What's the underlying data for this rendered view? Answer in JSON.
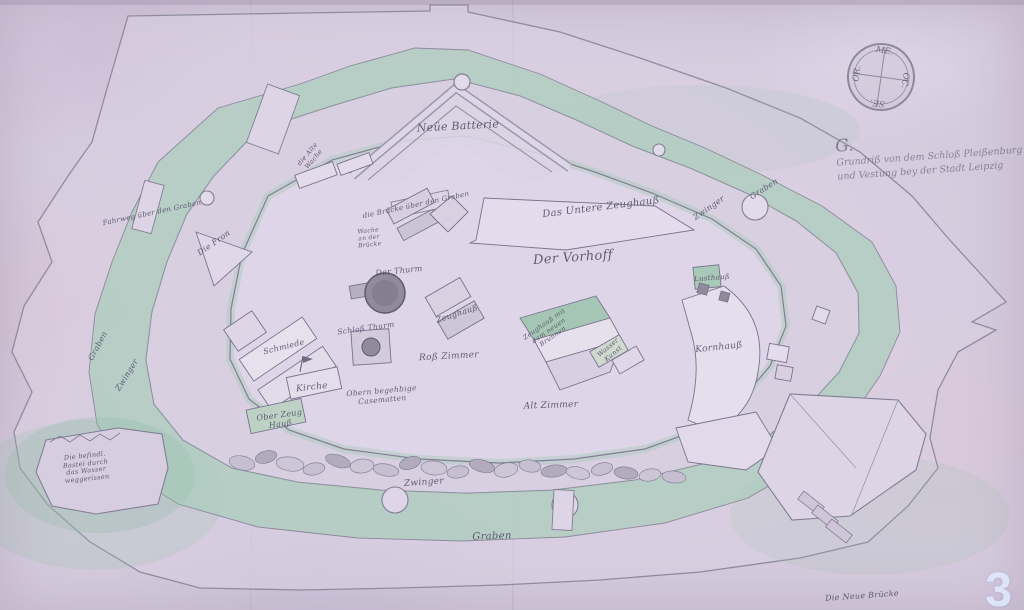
{
  "document": {
    "kind": "historic hand-drawn fortress plan (scanned manuscript map)",
    "watermark_number": "3"
  },
  "colors": {
    "paper": "#d6cbde",
    "moat_green": "#aecdbf",
    "ink": "#4e4660",
    "wall_line": "#827e93",
    "tower_shade": "#8f8a9c"
  },
  "title_block": {
    "flourish": "G.",
    "line1": "Grundriß von dem Schloß Pleißenburg",
    "line2": "und Vestung bey der Stadt Leipzig"
  },
  "compass": {
    "top": "ME.",
    "right": "OC.",
    "bottom": "SE.",
    "left": "OR."
  },
  "watermark": "3",
  "map_labels": [
    {
      "text": "Neüe Batterie",
      "x": 458,
      "y": 127,
      "rot": -3,
      "size": 11
    },
    {
      "text": "die Alte\nWache",
      "x": 311,
      "y": 157,
      "rot": -50,
      "size": 6.5
    },
    {
      "text": "Fahrweg über den Graben",
      "x": 152,
      "y": 213,
      "rot": -12,
      "size": 7
    },
    {
      "text": "Die Fron",
      "x": 214,
      "y": 243,
      "rot": -35,
      "size": 8
    },
    {
      "text": "die Brücke über den Graben",
      "x": 416,
      "y": 205,
      "rot": -12,
      "size": 7
    },
    {
      "text": "Wache\nan der\nBrücke",
      "x": 369,
      "y": 238,
      "rot": -6,
      "size": 6
    },
    {
      "text": "Das Untere Zeughauß",
      "x": 601,
      "y": 208,
      "rot": -7,
      "size": 10
    },
    {
      "text": "Der Vorhoff",
      "x": 573,
      "y": 258,
      "rot": -4,
      "size": 13
    },
    {
      "text": "Der Thurm",
      "x": 399,
      "y": 271,
      "rot": -6,
      "size": 8
    },
    {
      "text": "Zeughauß",
      "x": 457,
      "y": 314,
      "rot": -18,
      "size": 8
    },
    {
      "text": "Schloß Thurm",
      "x": 366,
      "y": 329,
      "rot": -8,
      "size": 7.5
    },
    {
      "text": "Schmiede",
      "x": 284,
      "y": 347,
      "rot": -14,
      "size": 8
    },
    {
      "text": "Kirche",
      "x": 312,
      "y": 388,
      "rot": -6,
      "size": 9
    },
    {
      "text": "Roß Zimmer",
      "x": 449,
      "y": 357,
      "rot": -3,
      "size": 9
    },
    {
      "text": "Obern begehbige\nCasematten",
      "x": 382,
      "y": 396,
      "rot": -5,
      "size": 7.5
    },
    {
      "text": "Ober Zeug\nHauß",
      "x": 280,
      "y": 420,
      "rot": -8,
      "size": 8
    },
    {
      "text": "Zeughauß mit\ndem neuen\nBrunnen",
      "x": 549,
      "y": 331,
      "rot": -35,
      "size": 6.5
    },
    {
      "text": "Wasser\nKunst",
      "x": 611,
      "y": 351,
      "rot": -40,
      "size": 6.5
    },
    {
      "text": "Alt Zimmer",
      "x": 551,
      "y": 406,
      "rot": -2,
      "size": 9
    },
    {
      "text": "Kornhauß",
      "x": 719,
      "y": 348,
      "rot": -6,
      "size": 9
    },
    {
      "text": "Lusthauß",
      "x": 712,
      "y": 278,
      "rot": -4,
      "size": 7
    },
    {
      "text": "Zwinger",
      "x": 709,
      "y": 208,
      "rot": -35,
      "size": 8
    },
    {
      "text": "Graben",
      "x": 764,
      "y": 189,
      "rot": -33,
      "size": 8
    },
    {
      "text": "Graben",
      "x": 98,
      "y": 346,
      "rot": -62,
      "size": 8
    },
    {
      "text": "Zwinger",
      "x": 127,
      "y": 375,
      "rot": -58,
      "size": 8
    },
    {
      "text": "Zwinger",
      "x": 424,
      "y": 483,
      "rot": -4,
      "size": 9
    },
    {
      "text": "Graben",
      "x": 492,
      "y": 537,
      "rot": -2,
      "size": 10
    },
    {
      "text": "Die befindl.\nBastei durch\ndas Wasser\nweggerissen",
      "x": 86,
      "y": 468,
      "rot": -6,
      "size": 6.5
    },
    {
      "text": "Die Neue Brücke",
      "x": 862,
      "y": 596,
      "rot": -4,
      "size": 8
    }
  ]
}
